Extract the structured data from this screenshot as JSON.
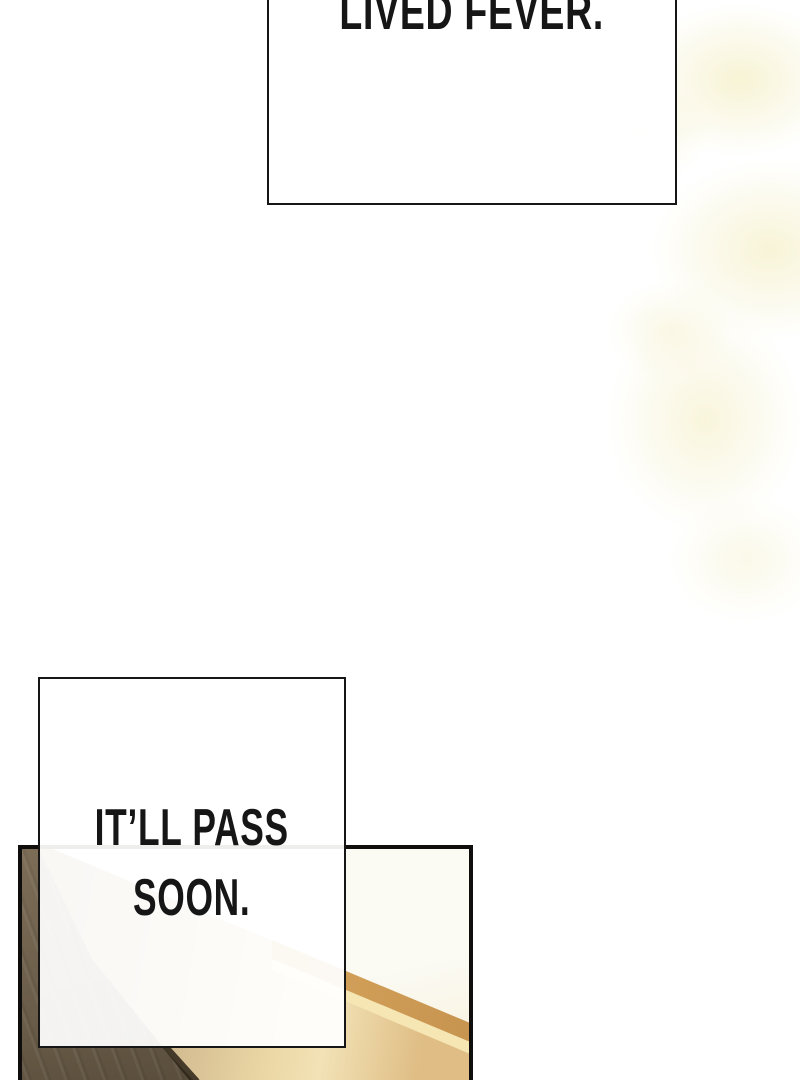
{
  "bubbles": {
    "top": {
      "text": "LIVED FEVER."
    },
    "middle": {
      "line1": "IT’LL PASS",
      "line2": "SOON."
    }
  },
  "colors": {
    "paper": "#ffffff",
    "paper_tint": "#f6f1cf",
    "ink": "#161616",
    "panel_border": "#0f0e0c",
    "wall": "#fbfaf3",
    "wall_warm": "#f7efd7",
    "wood_dark_top": "#7c6d57",
    "wood_dark_mid": "#695c48",
    "wood_dark_deep": "#463b2d",
    "edge_line": "#2c2318",
    "surface_dark": "#a9936f",
    "surface_mid": "#c9b189",
    "surface_light": "#ecd8a6",
    "surface_tan": "#dfbd84",
    "gold_band_light": "#dcaa62",
    "gold_band_deep": "#c89550",
    "cream_stripe": "#f5e6b4"
  }
}
